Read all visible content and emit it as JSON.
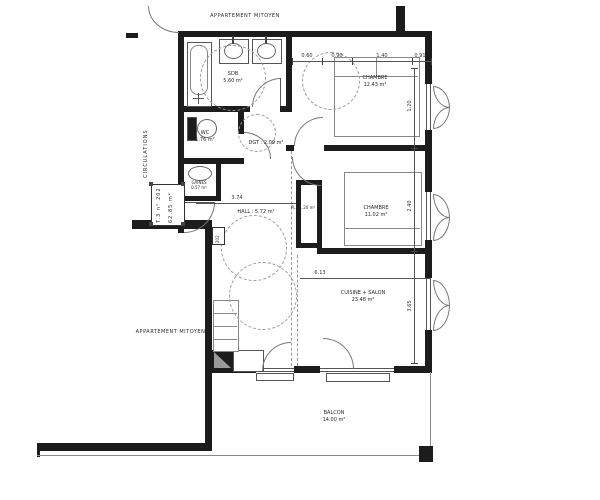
{
  "plan": {
    "annotations": {
      "neighbor_top": "APPARTEMENT MITOYEN",
      "neighbor_left": "APPARTEMENT MITOYEN",
      "circulations": "CIRCULATIONS",
      "unit_tag_line1": "T.3 n° 202",
      "unit_tag_line2": "62.85 m²",
      "door_plate": "202"
    },
    "rooms": {
      "sdb": {
        "name": "SDB",
        "area": "5.60 m²"
      },
      "wc": {
        "name": "WC",
        "area": "1.76 m²"
      },
      "gaine": {
        "name": "GAINES",
        "area": "0.57 m²"
      },
      "dgt": {
        "label": "DGT : 2.09 m²"
      },
      "hall": {
        "label": "HALL : 5.72 m²"
      },
      "placard": {
        "label": "PL : 1.20 m²"
      },
      "chambre1": {
        "name": "CHAMBRE",
        "area": "12.43 m²"
      },
      "chambre2": {
        "name": "CHAMBRE",
        "area": "11.02 m²"
      },
      "cuisine": {
        "name": "CUISINE + SALON",
        "area": "23.48 m²"
      },
      "balcon": {
        "name": "BALCON",
        "area": "14.00 m²"
      }
    },
    "dimensions": {
      "top": [
        "0.60",
        "0.90",
        "1.40",
        "0.91"
      ],
      "right": [
        "1.20",
        "2.40",
        "3.65"
      ],
      "hall_width": "3.74",
      "cuisine_width": "6.13"
    },
    "colors": {
      "wall": "#1c1c1c",
      "line": "#555555",
      "dash": "#999999"
    }
  }
}
